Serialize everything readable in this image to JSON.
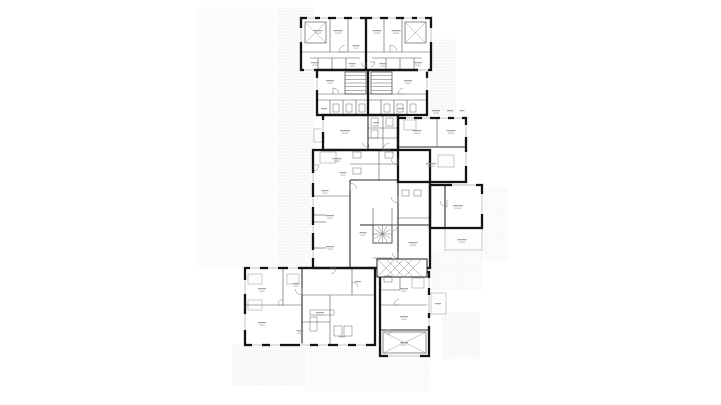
{
  "page": {
    "kind": "architectural-floor-plan",
    "background": "#ffffff"
  },
  "colors": {
    "wall": "#141414",
    "medium": "#2a2a2a",
    "thin": "#565656",
    "detail": "#8d8d8d",
    "window": "#bdbdbd",
    "label": "#979797",
    "light_border": "#b3b3b3",
    "light_fill": "#fdfdfd",
    "hatch": "#8a8a8a",
    "fixture": "#6a6a6a"
  },
  "strokes": {
    "thick": 2.3,
    "medium": 1.1,
    "thin": 0.6,
    "detail": 0.5,
    "window": 0.9,
    "window_erase": 3.2
  },
  "floorplan": {
    "canvas": {
      "width": 721,
      "height": 405
    },
    "grid_step": 3,
    "grid_patches": [
      {
        "x": 198,
        "y": 8,
        "w": 82,
        "h": 260,
        "c": "#f2f2f2"
      },
      {
        "x": 280,
        "y": 8,
        "w": 33,
        "h": 259,
        "c": "#ebebeb"
      },
      {
        "x": 431,
        "y": 40,
        "w": 25,
        "h": 77,
        "c": "#e9e9e9"
      },
      {
        "x": 482,
        "y": 188,
        "w": 26,
        "h": 72,
        "c": "#f0f0f0"
      },
      {
        "x": 430,
        "y": 250,
        "w": 52,
        "h": 40,
        "c": "#efefef"
      },
      {
        "x": 443,
        "y": 313,
        "w": 37,
        "h": 45,
        "c": "#ededed"
      },
      {
        "x": 233,
        "y": 345,
        "w": 72,
        "h": 40,
        "c": "#ededed"
      },
      {
        "x": 305,
        "y": 348,
        "w": 125,
        "h": 44,
        "c": "#f2f2f2"
      }
    ],
    "blocks": [
      {
        "name": "block-top",
        "x": 301,
        "y": 18,
        "w": 130,
        "h": 52
      },
      {
        "name": "block-neck",
        "x": 317,
        "y": 70,
        "w": 110,
        "h": 45
      },
      {
        "name": "block-mid-topleft",
        "x": 323,
        "y": 115,
        "w": 75,
        "h": 35
      },
      {
        "name": "block-mid-topright",
        "x": 398,
        "y": 118,
        "w": 68,
        "h": 64
      },
      {
        "name": "block-mid-main",
        "x": 313,
        "y": 150,
        "w": 117,
        "h": 118
      },
      {
        "name": "block-right-wing",
        "x": 430,
        "y": 185,
        "w": 52,
        "h": 43
      },
      {
        "name": "block-lower-left-wing",
        "x": 245,
        "y": 268,
        "w": 130,
        "h": 77
      },
      {
        "name": "block-bottom-right",
        "x": 380,
        "y": 272,
        "w": 49,
        "h": 84
      }
    ],
    "walls_thick": [
      [
        366,
        18,
        366,
        70
      ],
      [
        368,
        70,
        368,
        115
      ]
    ],
    "walls_medium": [
      [
        398,
        147,
        466,
        147
      ],
      [
        398,
        182,
        398,
        268
      ],
      [
        350,
        180,
        350,
        268
      ],
      [
        350,
        180,
        398,
        180
      ],
      [
        360,
        225,
        430,
        225
      ],
      [
        368,
        115,
        368,
        150
      ],
      [
        302,
        268,
        302,
        345
      ],
      [
        380,
        330,
        429,
        330
      ],
      [
        445,
        185,
        445,
        228
      ]
    ],
    "walls_thin": [
      [
        330,
        18,
        330,
        52
      ],
      [
        348,
        18,
        348,
        52
      ],
      [
        384,
        18,
        384,
        52
      ],
      [
        402,
        18,
        402,
        52
      ],
      [
        301,
        52,
        431,
        52
      ],
      [
        310,
        58,
        360,
        58
      ],
      [
        372,
        58,
        422,
        58
      ],
      [
        318,
        58,
        318,
        70
      ],
      [
        332,
        58,
        332,
        70
      ],
      [
        346,
        58,
        346,
        70
      ],
      [
        386,
        58,
        386,
        70
      ],
      [
        400,
        58,
        400,
        70
      ],
      [
        414,
        58,
        414,
        70
      ],
      [
        317,
        94,
        427,
        94
      ],
      [
        317,
        100,
        427,
        100
      ],
      [
        330,
        100,
        330,
        115
      ],
      [
        343,
        100,
        343,
        115
      ],
      [
        356,
        100,
        356,
        115
      ],
      [
        381,
        100,
        381,
        115
      ],
      [
        394,
        100,
        394,
        115
      ],
      [
        407,
        100,
        407,
        115
      ],
      [
        383,
        115,
        383,
        150
      ],
      [
        368,
        128,
        398,
        128
      ],
      [
        368,
        138,
        398,
        138
      ],
      [
        437,
        118,
        437,
        147
      ],
      [
        379,
        150,
        379,
        180
      ],
      [
        350,
        164,
        398,
        164
      ],
      [
        313,
        196,
        350,
        196
      ],
      [
        313,
        215,
        326,
        215
      ],
      [
        313,
        222,
        326,
        222
      ],
      [
        313,
        248,
        326,
        248
      ],
      [
        373,
        208,
        373,
        225
      ],
      [
        392,
        208,
        392,
        225
      ],
      [
        373,
        243,
        392,
        243
      ],
      [
        373,
        258,
        392,
        258
      ],
      [
        398,
        218,
        430,
        218
      ],
      [
        380,
        305,
        429,
        305
      ],
      [
        380,
        290,
        400,
        290
      ],
      [
        400,
        272,
        400,
        290
      ],
      [
        283,
        268,
        283,
        305
      ],
      [
        245,
        305,
        302,
        305
      ],
      [
        302,
        295,
        375,
        295
      ],
      [
        352,
        268,
        352,
        295
      ],
      [
        330,
        295,
        330,
        345
      ],
      [
        302,
        322,
        330,
        322
      ]
    ],
    "stairs": [
      {
        "x": 345,
        "y": 72,
        "w": 21,
        "h": 22,
        "steps": 6
      },
      {
        "x": 371,
        "y": 72,
        "w": 21,
        "h": 22,
        "steps": 6
      }
    ],
    "light_boxes": [
      {
        "name": "balcony-upper-left",
        "x": 314,
        "y": 129,
        "w": 10,
        "h": 13
      },
      {
        "name": "terrace-right",
        "x": 445,
        "y": 228,
        "w": 37,
        "h": 22
      },
      {
        "name": "balcony-bottom-right",
        "x": 431,
        "y": 293,
        "w": 15,
        "h": 21
      },
      {
        "name": "furniture",
        "x": 320,
        "y": 152,
        "w": 16,
        "h": 11
      },
      {
        "name": "furniture",
        "x": 438,
        "y": 155,
        "w": 16,
        "h": 12
      },
      {
        "name": "furniture",
        "x": 404,
        "y": 120,
        "w": 12,
        "h": 10
      },
      {
        "name": "furniture",
        "x": 248,
        "y": 274,
        "w": 14,
        "h": 10
      },
      {
        "name": "furniture",
        "x": 287,
        "y": 274,
        "w": 12,
        "h": 10
      },
      {
        "name": "furniture",
        "x": 248,
        "y": 300,
        "w": 14,
        "h": 10
      },
      {
        "name": "furniture",
        "x": 412,
        "y": 278,
        "w": 12,
        "h": 10
      }
    ],
    "hatch_rects": [
      {
        "name": "ramp",
        "x": 377,
        "y": 259,
        "w": 50,
        "h": 18,
        "step": 9
      }
    ],
    "xboxes": [
      {
        "name": "shaft-top-left",
        "x": 305,
        "y": 22,
        "w": 21,
        "h": 21
      },
      {
        "name": "shaft-top-right",
        "x": 405,
        "y": 22,
        "w": 21,
        "h": 21
      },
      {
        "name": "void-bottom-right",
        "x": 383,
        "y": 332,
        "w": 43,
        "h": 21
      }
    ],
    "spirals": [
      {
        "name": "spiral-stair",
        "x": 373,
        "y": 225,
        "w": 19,
        "h": 18,
        "rays": 12
      }
    ],
    "windows": [
      [
        307,
        18,
        315,
        18
      ],
      [
        320,
        18,
        328,
        18
      ],
      [
        336,
        18,
        344,
        18
      ],
      [
        352,
        18,
        360,
        18
      ],
      [
        372,
        18,
        380,
        18
      ],
      [
        388,
        18,
        396,
        18
      ],
      [
        404,
        18,
        412,
        18
      ],
      [
        417,
        18,
        425,
        18
      ],
      [
        301,
        28,
        301,
        42
      ],
      [
        431,
        28,
        431,
        42
      ],
      [
        304,
        70,
        314,
        70
      ],
      [
        418,
        70,
        428,
        70
      ],
      [
        317,
        78,
        317,
        90
      ],
      [
        427,
        78,
        427,
        90
      ],
      [
        323,
        120,
        323,
        132
      ],
      [
        406,
        118,
        414,
        118
      ],
      [
        422,
        118,
        430,
        118
      ],
      [
        440,
        118,
        448,
        118
      ],
      [
        454,
        118,
        462,
        118
      ],
      [
        466,
        125,
        466,
        137
      ],
      [
        466,
        152,
        466,
        166
      ],
      [
        313,
        173,
        313,
        183
      ],
      [
        313,
        197,
        313,
        207
      ],
      [
        313,
        225,
        313,
        233
      ],
      [
        313,
        250,
        313,
        258
      ],
      [
        452,
        185,
        476,
        185
      ],
      [
        482,
        194,
        482,
        214
      ],
      [
        245,
        280,
        245,
        294
      ],
      [
        245,
        314,
        245,
        330
      ],
      [
        250,
        268,
        260,
        268
      ],
      [
        268,
        268,
        278,
        268
      ],
      [
        288,
        268,
        298,
        268
      ],
      [
        252,
        345,
        262,
        345
      ],
      [
        270,
        345,
        280,
        345
      ],
      [
        300,
        345,
        310,
        345
      ],
      [
        318,
        345,
        328,
        345
      ],
      [
        338,
        345,
        348,
        345
      ],
      [
        356,
        345,
        366,
        345
      ],
      [
        429,
        278,
        429,
        288
      ],
      [
        429,
        295,
        429,
        313
      ],
      [
        429,
        318,
        429,
        326
      ],
      [
        388,
        356,
        420,
        356
      ]
    ],
    "fixtures": [
      [
        333,
        104,
        6,
        8
      ],
      [
        346,
        104,
        6,
        8
      ],
      [
        359,
        104,
        6,
        8
      ],
      [
        384,
        104,
        6,
        8
      ],
      [
        397,
        104,
        6,
        8
      ],
      [
        410,
        104,
        6,
        8
      ],
      [
        371,
        118,
        7,
        8
      ],
      [
        386,
        118,
        7,
        8
      ],
      [
        371,
        130,
        7,
        8
      ],
      [
        353,
        152,
        8,
        6
      ],
      [
        353,
        168,
        8,
        6
      ],
      [
        385,
        152,
        8,
        6
      ],
      [
        334,
        326,
        8,
        10
      ],
      [
        344,
        326,
        8,
        10
      ],
      [
        384,
        276,
        8,
        6
      ],
      [
        310,
        310,
        24,
        5
      ],
      [
        310,
        317,
        7,
        14
      ],
      [
        402,
        190,
        7,
        6
      ],
      [
        414,
        190,
        7,
        6
      ]
    ],
    "arcs": [
      [
        346,
        52,
        7,
        180
      ],
      [
        390,
        52,
        7,
        270
      ],
      [
        333,
        94,
        6,
        270
      ],
      [
        404,
        94,
        6,
        180
      ],
      [
        368,
        141,
        6,
        80
      ],
      [
        390,
        150,
        7,
        180
      ],
      [
        398,
        158,
        7,
        90
      ],
      [
        350,
        190,
        7,
        270
      ],
      [
        398,
        196,
        7,
        90
      ],
      [
        392,
        225,
        6,
        0
      ],
      [
        398,
        252,
        6,
        90
      ],
      [
        302,
        288,
        7,
        90
      ],
      [
        284,
        305,
        6,
        180
      ],
      [
        352,
        288,
        6,
        270
      ],
      [
        400,
        305,
        6,
        180
      ],
      [
        386,
        330,
        5,
        0
      ],
      [
        447,
        200,
        7,
        90
      ],
      [
        366,
        62,
        5,
        90
      ],
      [
        370,
        62,
        5,
        0
      ],
      [
        330,
        268,
        6,
        0
      ],
      [
        313,
        165,
        6,
        0
      ]
    ],
    "labels": [
      [
        318,
        30,
        9
      ],
      [
        338,
        30,
        9
      ],
      [
        377,
        30,
        9
      ],
      [
        396,
        30,
        9
      ],
      [
        356,
        45,
        7
      ],
      [
        315,
        62,
        8
      ],
      [
        352,
        63,
        7
      ],
      [
        383,
        63,
        7
      ],
      [
        418,
        62,
        8
      ],
      [
        330,
        80,
        8
      ],
      [
        408,
        80,
        8
      ],
      [
        324,
        108,
        6
      ],
      [
        401,
        108,
        6
      ],
      [
        345,
        130,
        10
      ],
      [
        376,
        122,
        6
      ],
      [
        417,
        130,
        9
      ],
      [
        451,
        130,
        9
      ],
      [
        431,
        163,
        10
      ],
      [
        337,
        158,
        9
      ],
      [
        343,
        172,
        7
      ],
      [
        325,
        190,
        7
      ],
      [
        330,
        215,
        8
      ],
      [
        330,
        246,
        8
      ],
      [
        363,
        232,
        7
      ],
      [
        413,
        242,
        9
      ],
      [
        458,
        205,
        10
      ],
      [
        462,
        239,
        9
      ],
      [
        262,
        288,
        8
      ],
      [
        262,
        322,
        8
      ],
      [
        296,
        283,
        7
      ],
      [
        320,
        312,
        8
      ],
      [
        300,
        330,
        7
      ],
      [
        358,
        281,
        6
      ],
      [
        342,
        336,
        6
      ],
      [
        404,
        288,
        8
      ],
      [
        404,
        316,
        8
      ],
      [
        404,
        342,
        8
      ],
      [
        438,
        303,
        6
      ],
      [
        436,
        110,
        8
      ],
      [
        450,
        110,
        6
      ],
      [
        462,
        110,
        5
      ]
    ]
  }
}
